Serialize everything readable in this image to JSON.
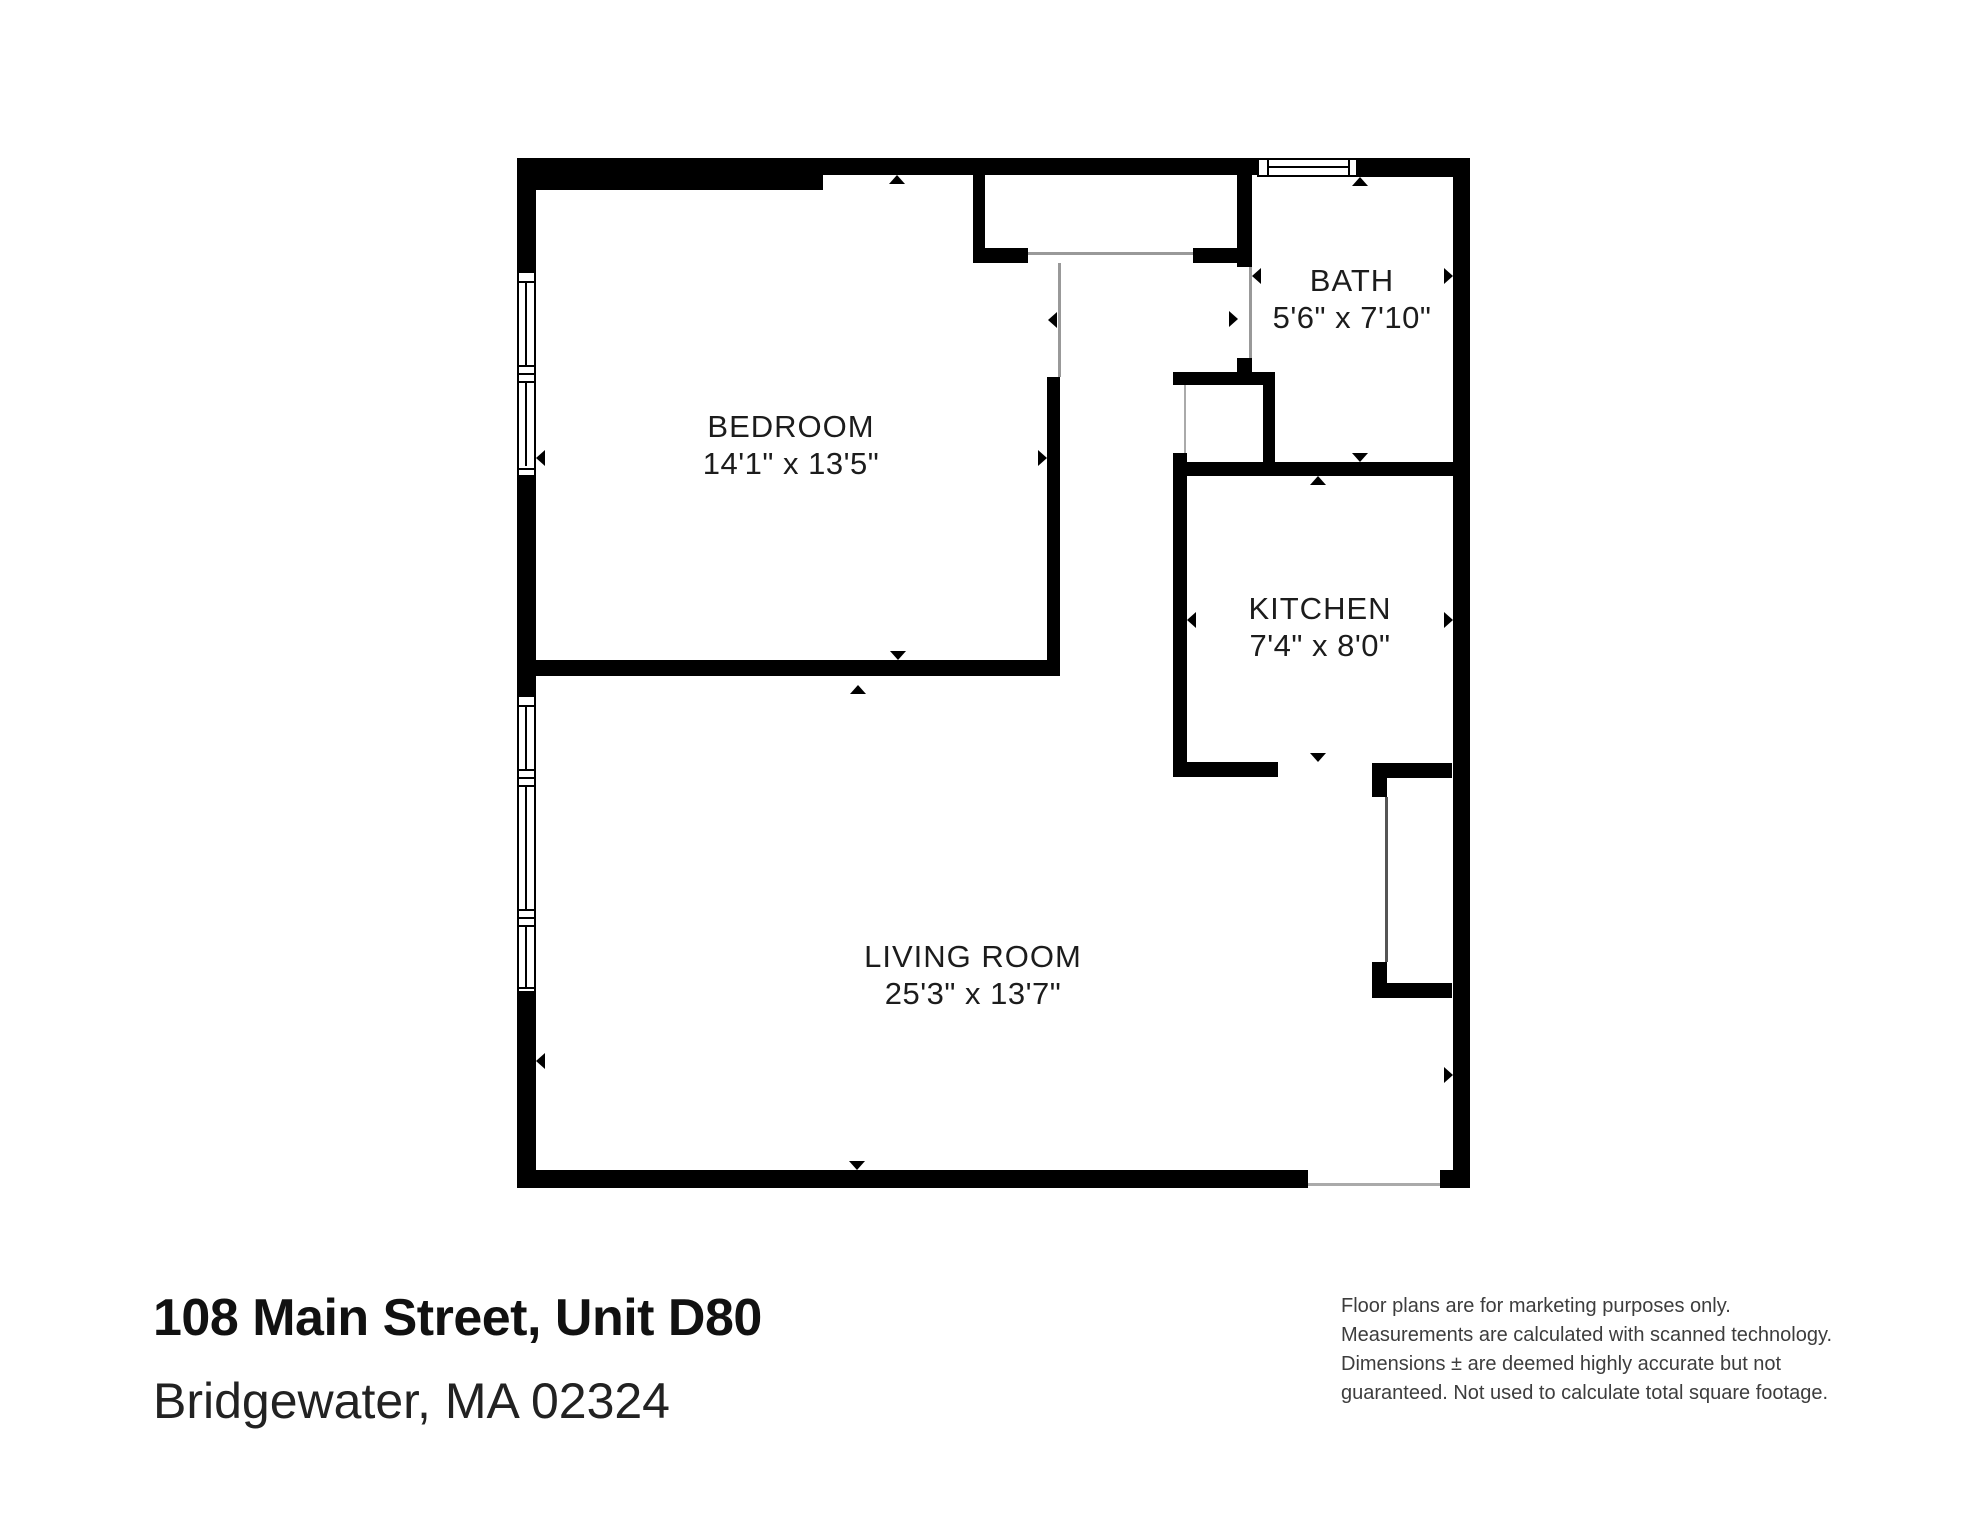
{
  "plan": {
    "rooms": [
      {
        "id": "bedroom",
        "name": "BEDROOM",
        "dims": "14'1\" x 13'5\""
      },
      {
        "id": "bath",
        "name": "BATH",
        "dims": "5'6\" x 7'10\""
      },
      {
        "id": "kitchen",
        "name": "KITCHEN",
        "dims": "7'4\" x 8'0\""
      },
      {
        "id": "living_room",
        "name": "LIVING ROOM",
        "dims": "25'3\" x 13'7\""
      }
    ]
  },
  "footer": {
    "address_line1": "108 Main Street, Unit D80",
    "address_line2": "Bridgewater, MA 02324",
    "disclaimer_lines": [
      "Floor plans are for marketing purposes only.",
      "Measurements are calculated with scanned technology.",
      "Dimensions ± are deemed highly accurate but not",
      "guaranteed. Not used to calculate total square footage."
    ]
  },
  "colors": {
    "wall": "#000000",
    "background": "#ffffff"
  }
}
